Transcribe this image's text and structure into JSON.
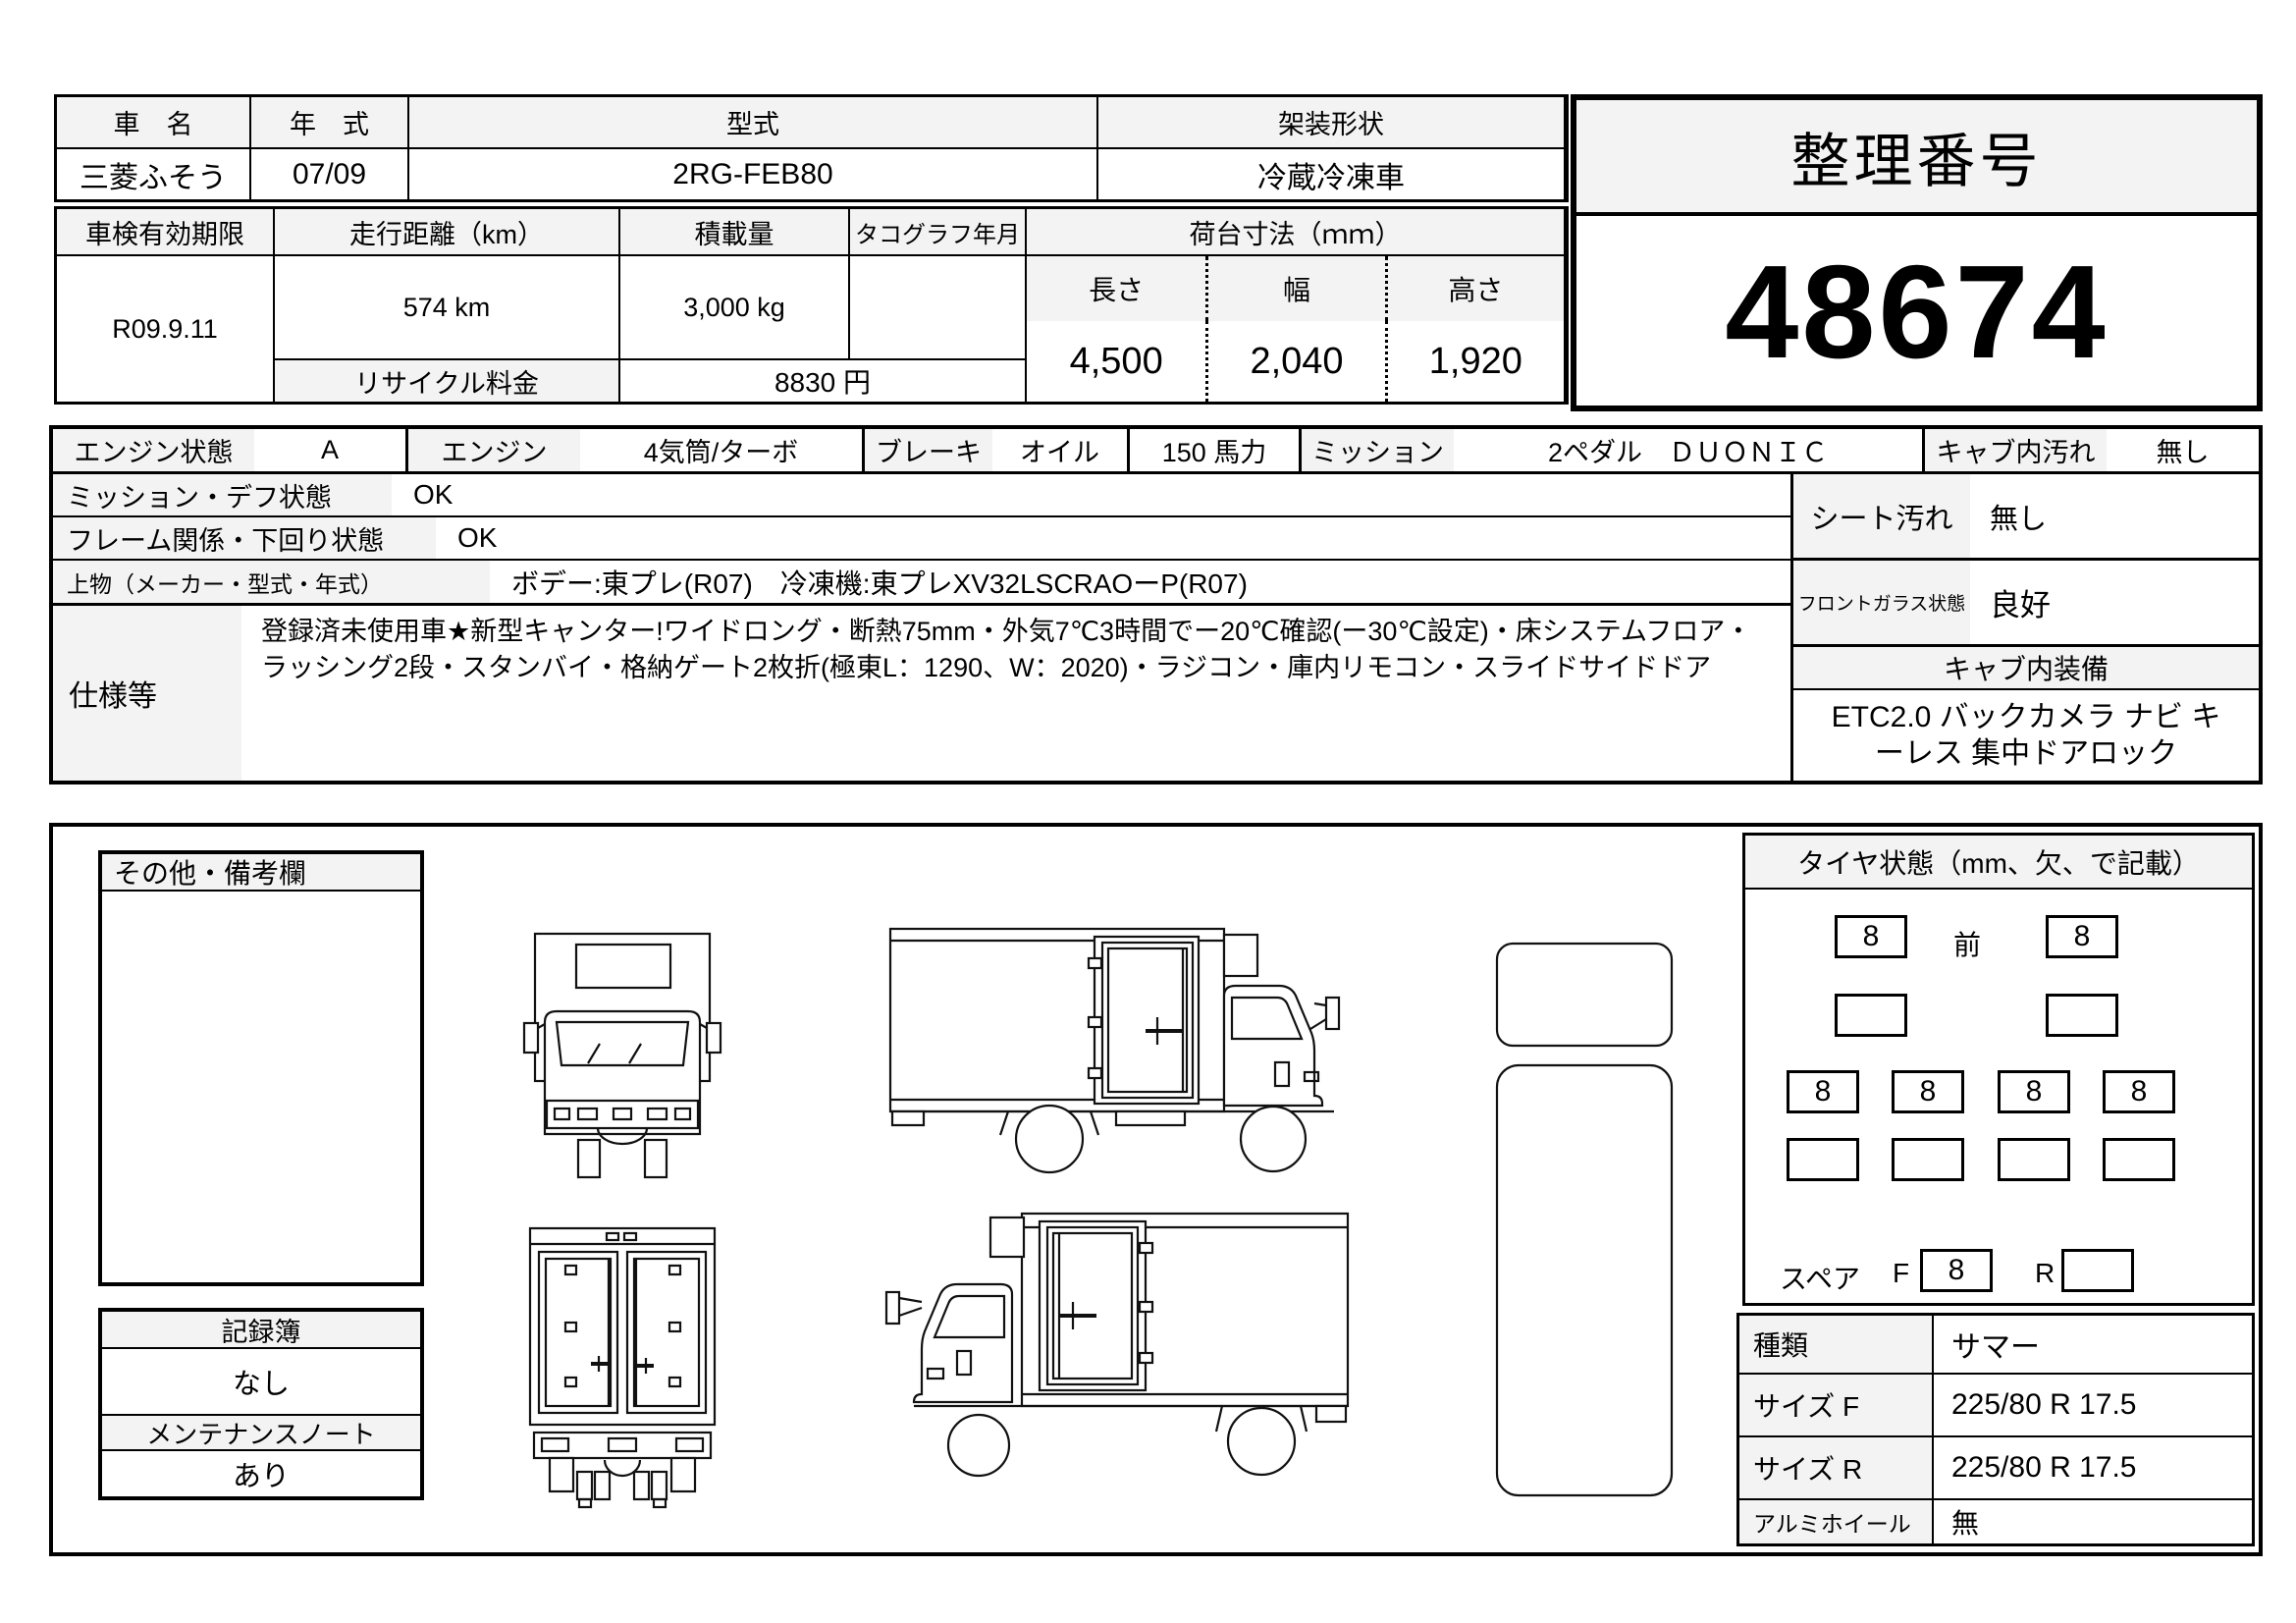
{
  "top": {
    "name_label": "車　名",
    "name_value": "三菱ふそう",
    "year_label": "年　式",
    "year_value": "07/09",
    "model_label": "型式",
    "model_value": "2RG-FEB80",
    "body_label": "架装形状",
    "body_value": "冷蔵冷凍車"
  },
  "ref": {
    "label": "整理番号",
    "value": "48674"
  },
  "insp": {
    "shaken_label": "車検有効期限",
    "shaken_value": "R09.9.11",
    "mileage_label": "走行距離（km）",
    "mileage_value": "574 km",
    "payload_label": "積載量",
    "payload_value": "3,000 kg",
    "tacho_label": "タコグラフ年月",
    "tacho_value": "",
    "recycle_label": "リサイクル料金",
    "recycle_value": "8830 円",
    "bed_label": "荷台寸法（ｍｍ）",
    "len_label": "長さ",
    "len_value": "4,500",
    "wid_label": "幅",
    "wid_value": "2,040",
    "hgt_label": "高さ",
    "hgt_value": "1,920"
  },
  "cond": {
    "engine_state_label": "エンジン状態",
    "engine_state_value": "A",
    "engine_label": "エンジン",
    "engine_value": "4気筒/ターボ",
    "brake_label": "ブレーキ",
    "brake_value": "オイル",
    "power_value": "150 馬力",
    "mission_label": "ミッション",
    "mission_value": "2ペダル　ＤＵＯＮＩＣ",
    "cab_dirt_label": "キャブ内汚れ",
    "cab_dirt_value": "無し",
    "mission_diff_label": "ミッション・デフ状態",
    "mission_diff_value": "OK",
    "frame_label": "フレーム関係・下回り状態",
    "frame_value": "OK",
    "ue_label": "上物（メーカー・型式・年式）",
    "ue_value": "ボデー:東プレ(R07)　冷凍機:東プレXV32LSCRAOーP(R07)",
    "spec_label": "仕様等",
    "spec_value": "登録済未使用車★新型キャンター!ワイドロング・断熱75mm・外気7℃3時間でー20℃確認(ー30℃設定)・床システムフロア・ラッシング2段・スタンバイ・格納ゲート2枚折(極東L：1290、W：2020)・ラジコン・庫内リモコン・スライドサイドドア",
    "seat_dirt_label": "シート汚れ",
    "seat_dirt_value": "無し",
    "glass_label": "フロントガラス状態",
    "glass_value": "良好",
    "equip_label": "キャブ内装備",
    "equip_value": "ETC2.0 バックカメラ ナビ キーレス 集中ドアロック"
  },
  "remarks": {
    "label": "その他・備考欄",
    "value": ""
  },
  "records": {
    "book_label": "記録簿",
    "book_value": "なし",
    "note_label": "メンテナンスノート",
    "note_value": "あり"
  },
  "tires": {
    "panel_label": "タイヤ状態（mm、欠、で記載）",
    "front_label": "前",
    "front_values": [
      "8",
      "8"
    ],
    "front_values2": [
      "",
      ""
    ],
    "rear_values": [
      "8",
      "8",
      "8",
      "8"
    ],
    "rear_values2": [
      "",
      "",
      "",
      ""
    ],
    "spare_label": "スペア",
    "spare_f_label": "F",
    "spare_f_value": "8",
    "spare_r_label": "R",
    "spare_r_value": "",
    "type_label": "種類",
    "type_value": "サマー",
    "size_f_label": "サイズ F",
    "size_f_value": "225/80 R 17.5",
    "size_r_label": "サイズ R",
    "size_r_value": "225/80 R 17.5",
    "alloy_label": "アルミホイール",
    "alloy_value": "無"
  },
  "colors": {
    "label_bg": "#f3f3f3",
    "border": "#000000",
    "paper": "#ffffff"
  }
}
